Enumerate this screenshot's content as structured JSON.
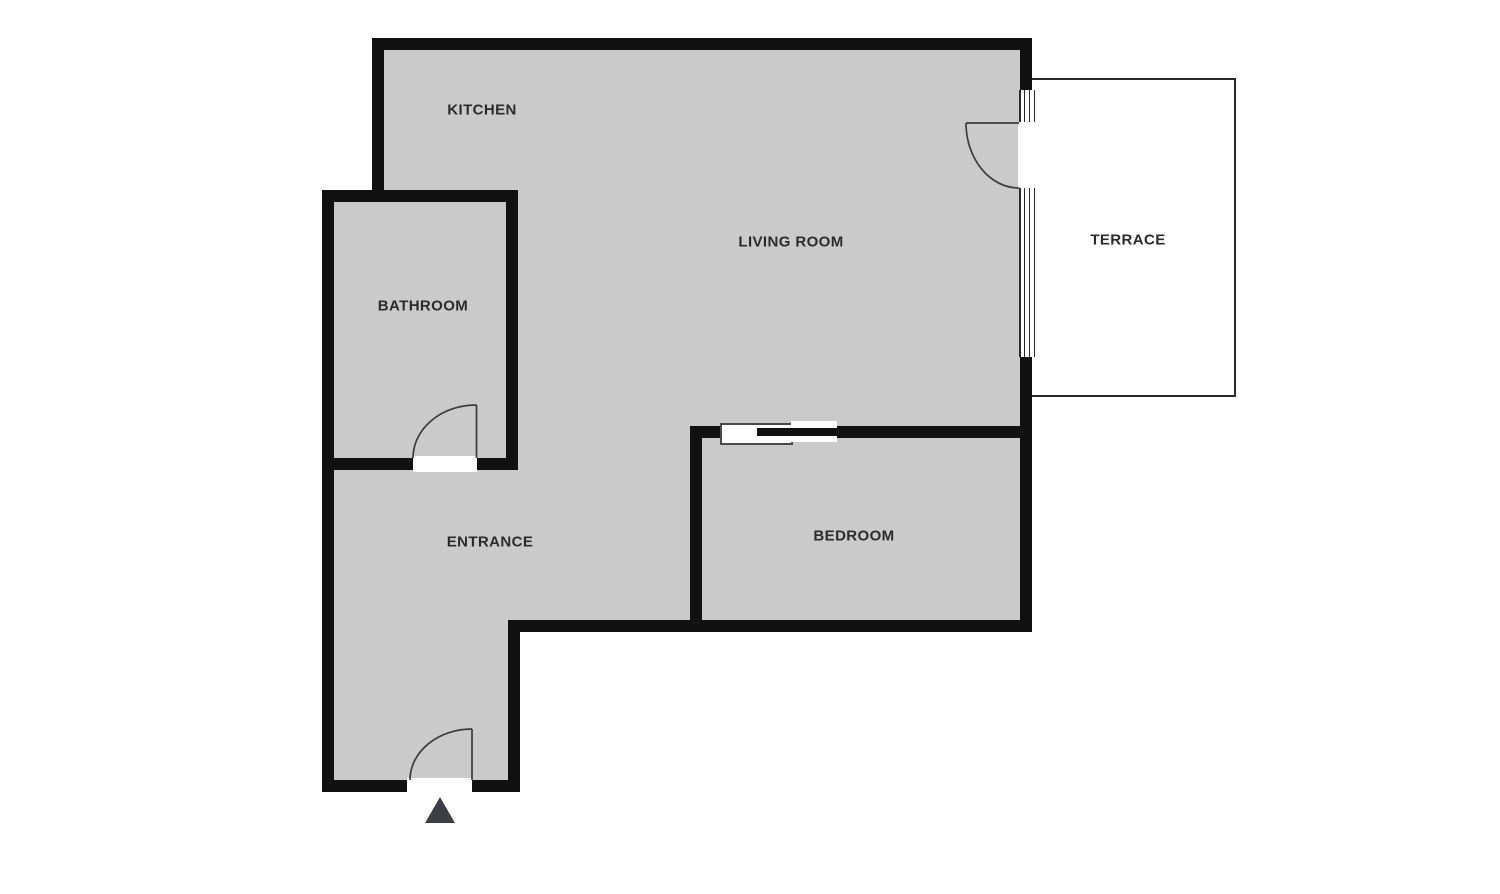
{
  "rooms": {
    "kitchen": {
      "label": "KITCHEN"
    },
    "living_room": {
      "label": "LIVING ROOM"
    },
    "terrace": {
      "label": "TERRACE"
    },
    "bathroom": {
      "label": "BATHROOM"
    },
    "entrance": {
      "label": "ENTRANCE"
    },
    "bedroom": {
      "label": "BEDROOM"
    }
  },
  "colors": {
    "background": "#ffffff",
    "floor_fill": "#cacaca",
    "wall": "#111111",
    "label_text": "#2b2b2b",
    "door_line": "#3c3c3c",
    "window_line": "#2a2a2a",
    "terrace_border": "#2a2a2a",
    "sliding_panel_border": "#4a4a4a",
    "entrance_arrow": "#3b3e45"
  },
  "icons": {
    "entrance_arrow": "triangle-up"
  }
}
